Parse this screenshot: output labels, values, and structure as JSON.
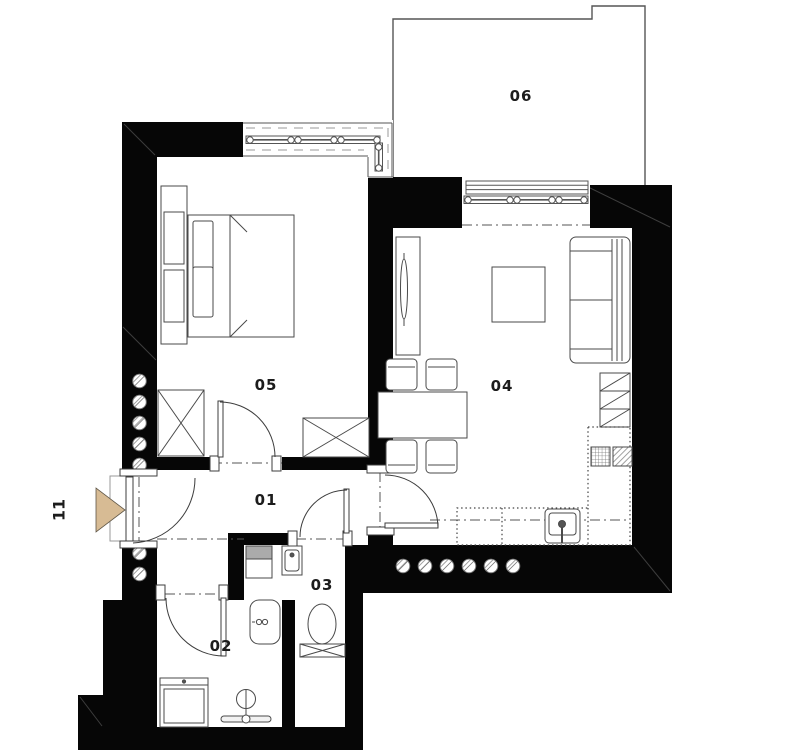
{
  "plan": {
    "rooms": {
      "r01": {
        "label": "01"
      },
      "r02": {
        "label": "02"
      },
      "r03": {
        "label": "03"
      },
      "r04": {
        "label": "04"
      },
      "r05": {
        "label": "05"
      },
      "r06": {
        "label": "06"
      }
    },
    "entrance": {
      "label": "11"
    },
    "colors": {
      "wall": "#000000",
      "background": "#ffffff",
      "line": "#4a4a4a",
      "entrance_arrow": "#d7bb94",
      "hatch": "#8f8f8f"
    }
  }
}
